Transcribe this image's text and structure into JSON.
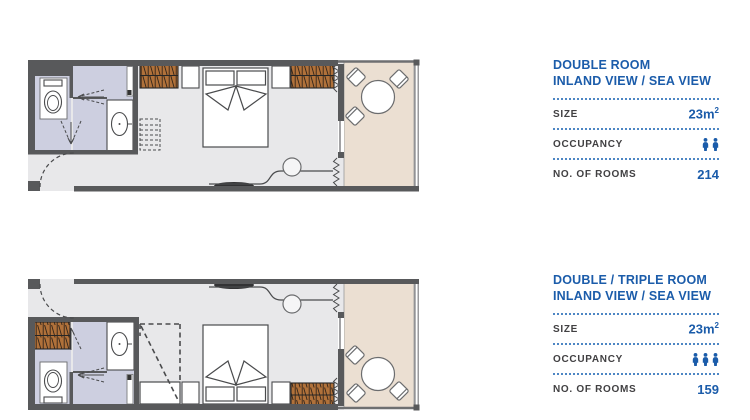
{
  "page": {
    "background": "#ffffff"
  },
  "panels": [
    {
      "title_line1": "DOUBLE ROOM",
      "title_line2": "INLAND VIEW / SEA VIEW",
      "size_label": "SIZE",
      "size_value": "23m",
      "size_sup": "2",
      "occupancy_label": "OCCUPANCY",
      "occupancy_count": 2,
      "rooms_label": "NO. OF ROOMS",
      "rooms_value": "214"
    },
    {
      "title_line1": "DOUBLE / TRIPLE ROOM",
      "title_line2": "INLAND VIEW / SEA VIEW",
      "size_label": "SIZE",
      "size_value": "23m",
      "size_sup": "2",
      "occupancy_label": "OCCUPANCY",
      "occupancy_count": 3,
      "rooms_label": "NO. OF ROOMS",
      "rooms_value": "159"
    }
  ],
  "plans": [
    {
      "name": "double-room-floor-plan"
    },
    {
      "name": "double-triple-room-floor-plan"
    }
  ],
  "icons": {
    "occupancy_person": "person-icon"
  },
  "colors": {
    "accent_blue": "#1b5caa",
    "dotted_line_blue": "#4d86c4",
    "label_gray": "#414042",
    "wall_gray": "#58595b",
    "floor_gray": "#e8e8ea",
    "bathroom_lavender": "#cdcfe0",
    "balcony_beige": "#ebdfd2",
    "wood_brown": "#b0713a",
    "outline_gray": "#4a4b4d"
  }
}
